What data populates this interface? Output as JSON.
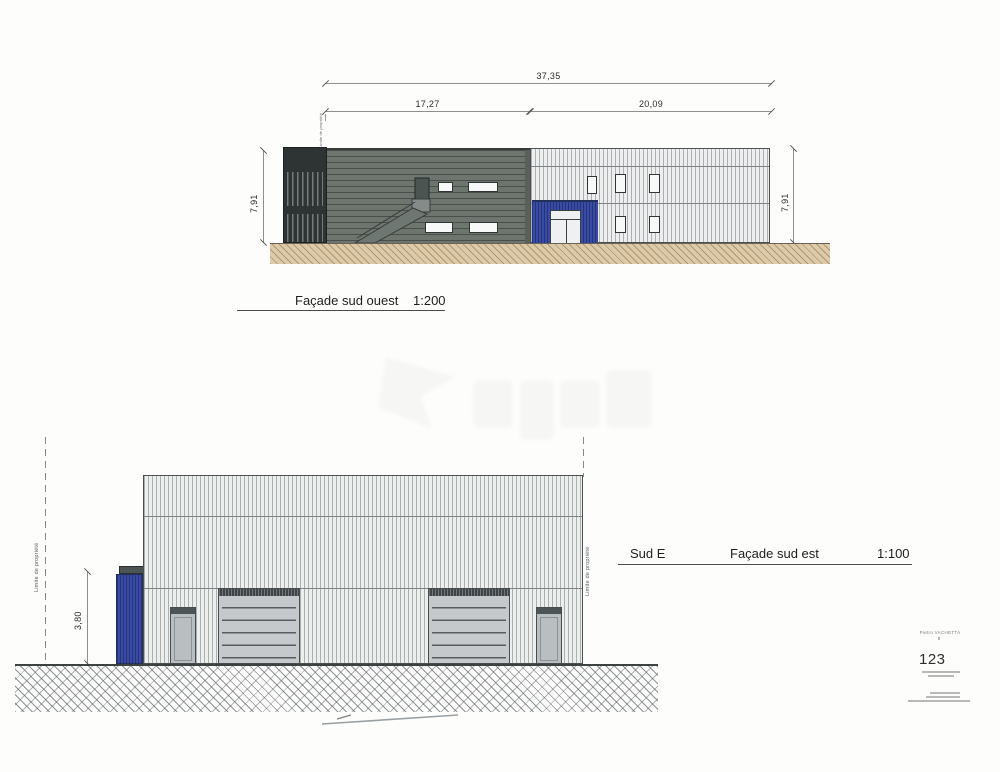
{
  "top_elevation": {
    "dim_total": "37,35",
    "dim_left_span": "17,27",
    "dim_right_span": "20,09",
    "dim_height_left": "7,91",
    "dim_height_right": "7,91",
    "boundary_label": "Limite de propriété",
    "caption_title": "Façade sud ouest",
    "caption_scale": "1:200"
  },
  "bottom_elevation": {
    "dim_height": "3,80",
    "boundary_label_left": "Limite de propriété",
    "boundary_label_right": "Limite de propriété",
    "caption_prefix": "Sud E",
    "caption_title": "Façade sud est",
    "caption_scale": "1:100"
  },
  "title_block": {
    "author": "Pietro VACHETTA",
    "sheet_number": "123"
  },
  "colors": {
    "blue_accent": "#3a4ba3",
    "dark_cladding": "#2e3334",
    "green_cladding": "#6e756f",
    "light_cladding": "#edefef",
    "terrain_tan": "#dccaa9"
  }
}
